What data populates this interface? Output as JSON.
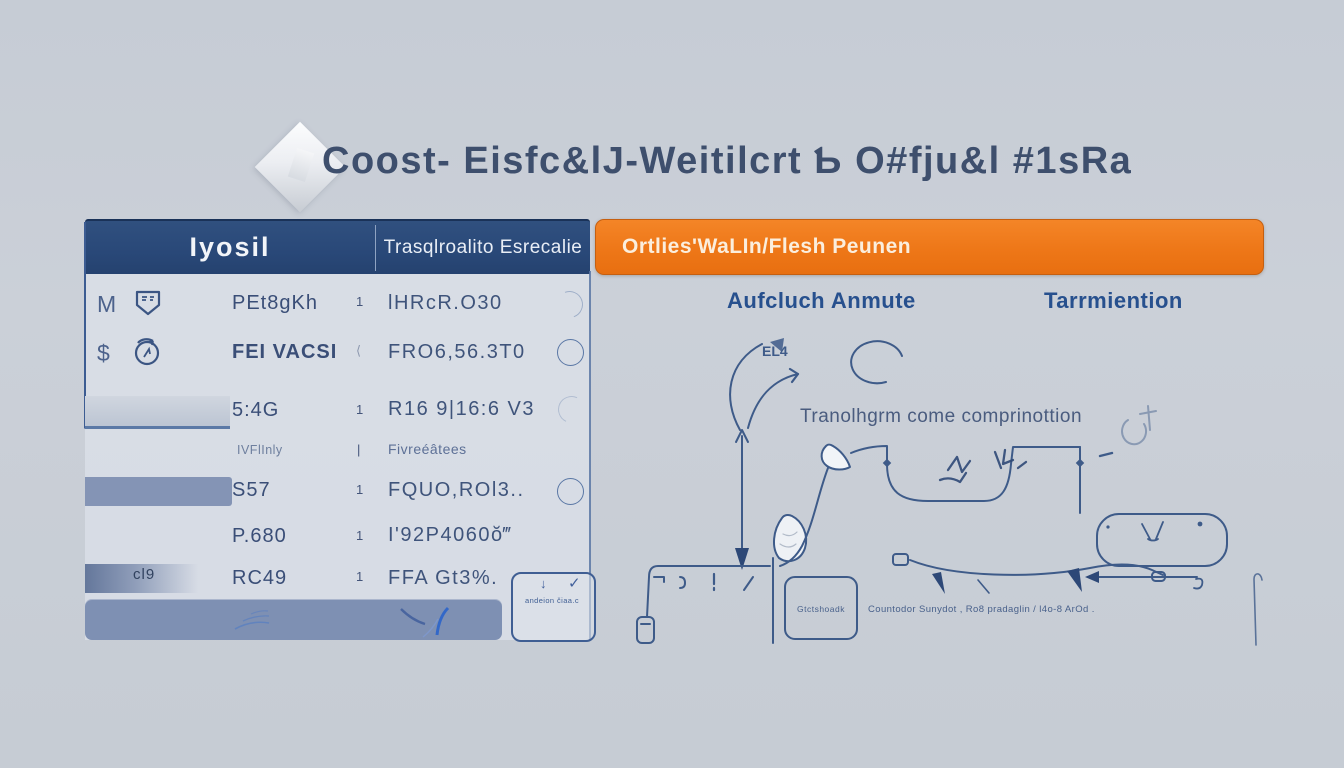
{
  "title": {
    "text": "Coost- Eisfc&lJ-Weitilcrt Ƅ O#fju&l #1sRa"
  },
  "table": {
    "header": {
      "left": "Iyosil",
      "right": "Trasqlroalito Esrecalie"
    },
    "rows": [
      {
        "icon_a": "M",
        "icon_b": "shield-icon",
        "name": "PEt8gKh",
        "sep": "1",
        "value": "lHRcR.O30",
        "circle": "faint"
      },
      {
        "icon_a": "$",
        "icon_b": "timer-icon",
        "name": "FEI VACSI",
        "sep": "⟨",
        "value": "FRO6,56.3T0",
        "circle": "solid"
      },
      {
        "bar": "light",
        "name": "5:4G",
        "sep": "1",
        "value": "R16 9|16:6 V3",
        "circle": "arc"
      },
      {
        "name": "IVFlInly",
        "sep": "|",
        "value": "Fivreéâtees"
      },
      {
        "bar": "solid",
        "name": "S57",
        "sep": "1",
        "value": "FQUO,ROl3..",
        "circle": "solid"
      },
      {
        "name": "P.680",
        "sep": "1",
        "value": "I'92P4060ŏ‴"
      },
      {
        "bar": "fade",
        "bar_label": "cl9",
        "name": "RC49",
        "sep": "1",
        "value": "FFA Gt3%."
      }
    ],
    "note_box": {
      "arrow": "↓",
      "check": "✓",
      "text": "andeion čiaa.c"
    }
  },
  "right": {
    "banner": "Ortlies'WaLIn/Flesh Peunen",
    "col1": "Aufcluch Anmute",
    "col2": "Tarrmiention",
    "diagram": {
      "arrow_label": "EL4",
      "caption": "Tranolhgrm come comprinottion",
      "box_label": "Gtctshoadk",
      "footnote": "Countodor Sunydot , Ro8 pradaglin / l4o-8 ArOd ."
    }
  },
  "colors": {
    "page_bg": "#c8cdd5",
    "header_blue": "#2b4a7a",
    "banner_orange": "#ee7718",
    "ink_blue": "#3e5b89",
    "panel_bg": "#dbe0e8",
    "bar_blue": "#7e90b3"
  }
}
